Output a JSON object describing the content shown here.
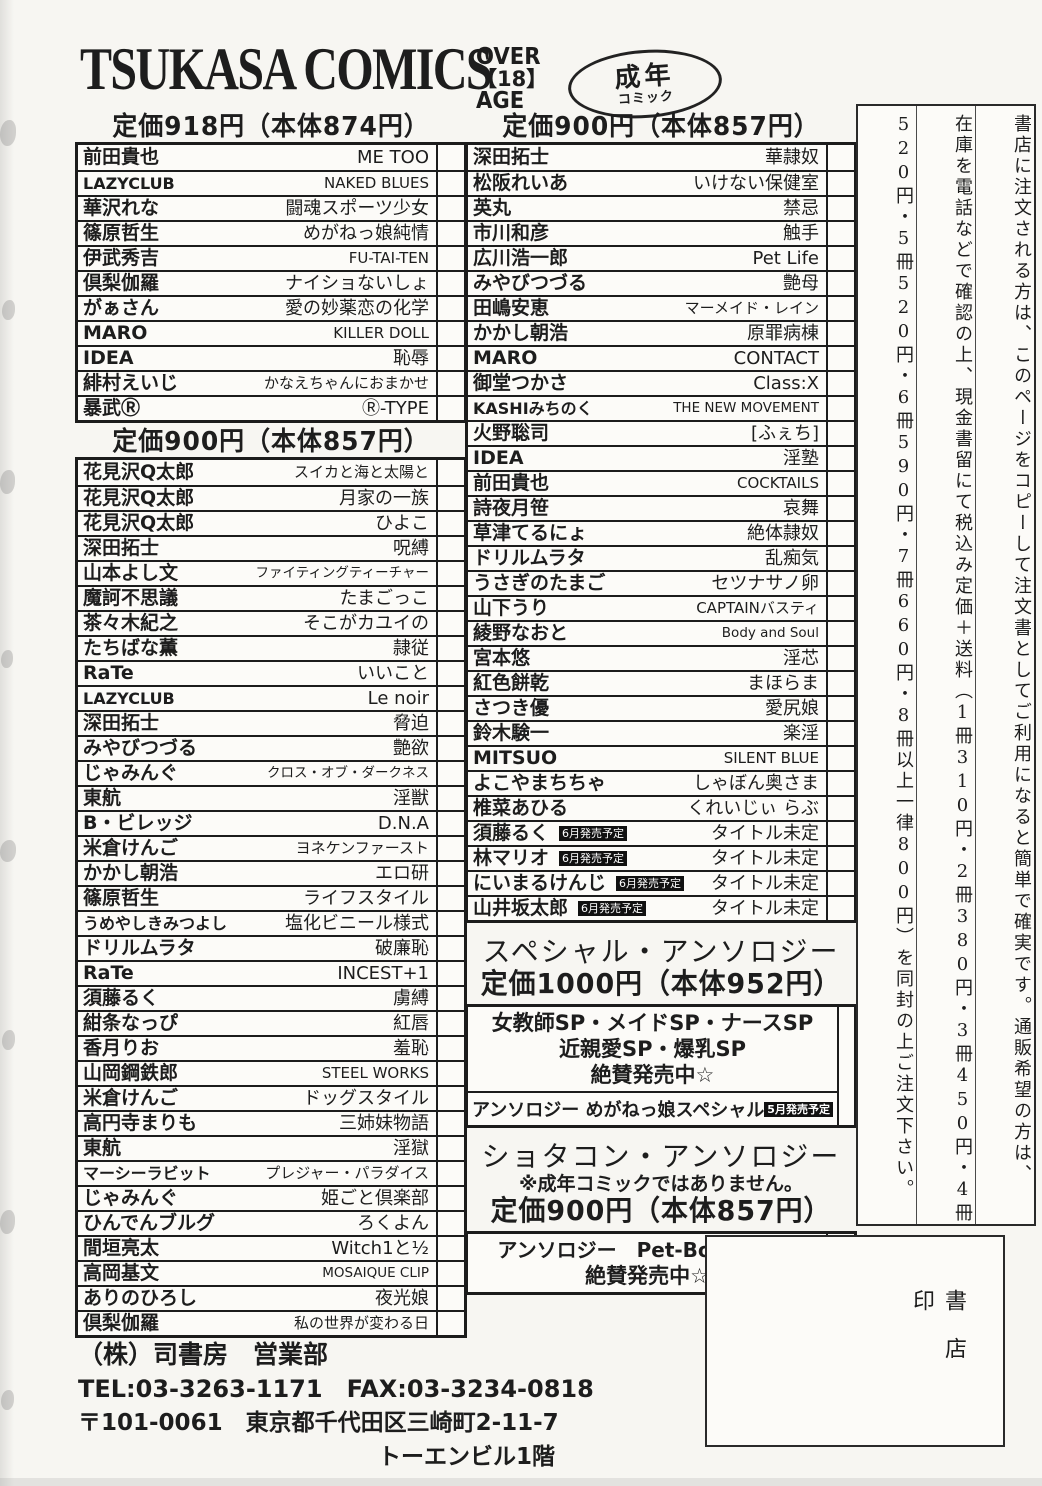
{
  "colors": {
    "ink": "#1d1d1d",
    "paper": "#f7f6f2",
    "badge_bg": "#111111",
    "badge_text": "#ffffff"
  },
  "header": {
    "logo": "TSUKASA COMICS",
    "age_badge": {
      "line1": "OVER",
      "line2": "【18】",
      "line3": "AGE"
    },
    "oval_badge": {
      "line1": "成年",
      "line2": "コミック"
    }
  },
  "sections": [
    {
      "header": "定価918円（本体874円）",
      "rows": [
        {
          "author": "前田貴也",
          "title": "ME TOO"
        },
        {
          "author": "LAZYCLUB",
          "title": "NAKED BLUES"
        },
        {
          "author": "華沢れな",
          "title": "闘魂スポーツ少女"
        },
        {
          "author": "篠原哲生",
          "title": "めがねっ娘純情"
        },
        {
          "author": "伊武秀吉",
          "title": "FU-TAI-TEN"
        },
        {
          "author": "倶梨伽羅",
          "title": "ナイショないしょ"
        },
        {
          "author": "がぁさん",
          "title": "愛の妙薬恋の化学"
        },
        {
          "author": "MARO",
          "title": "KILLER DOLL"
        },
        {
          "author": "IDEA",
          "title": "恥辱"
        },
        {
          "author": "緋村えいじ",
          "title": "かなえちゃんにおまかせ"
        },
        {
          "author": "暴武Ⓡ",
          "title": "Ⓡ-TYPE"
        }
      ]
    },
    {
      "header": "定価900円（本体857円）",
      "rows": [
        {
          "author": "花見沢Q太郎",
          "title": "スイカと海と太陽と"
        },
        {
          "author": "花見沢Q太郎",
          "title": "月家の一族"
        },
        {
          "author": "花見沢Q太郎",
          "title": "ひよこ"
        },
        {
          "author": "深田拓士",
          "title": "呪縛"
        },
        {
          "author": "山本よし文",
          "title": "ファイティングティーチャー"
        },
        {
          "author": "魔訶不思議",
          "title": "たまごっこ"
        },
        {
          "author": "茶々木紀之",
          "title": "そこがカユイの"
        },
        {
          "author": "たちばな薫",
          "title": "隷従"
        },
        {
          "author": "RaTe",
          "title": "いいこと"
        },
        {
          "author": "LAZYCLUB",
          "title": "Le noir"
        },
        {
          "author": "深田拓士",
          "title": "脅迫"
        },
        {
          "author": "みやびつづる",
          "title": "艶欲"
        },
        {
          "author": "じゃみんぐ",
          "title": "クロス・オブ・ダークネス"
        },
        {
          "author": "東航",
          "title": "淫獣"
        },
        {
          "author": "B・ビレッジ",
          "title": "D.N.A"
        },
        {
          "author": "米倉けんご",
          "title": "ヨネケンファースト"
        },
        {
          "author": "かかし朝浩",
          "title": "エロ研"
        },
        {
          "author": "篠原哲生",
          "title": "ライフスタイル"
        },
        {
          "author": "うめやしきみつよし",
          "title": "塩化ビニール様式"
        },
        {
          "author": "ドリルムラタ",
          "title": "破廉恥"
        },
        {
          "author": "RaTe",
          "title": "INCEST+1"
        },
        {
          "author": "須藤るく",
          "title": "虜縛"
        },
        {
          "author": "紺条なっぴ",
          "title": "紅唇"
        },
        {
          "author": "香月りお",
          "title": "羞恥"
        },
        {
          "author": "山岡鋼鉄郎",
          "title": "STEEL WORKS"
        },
        {
          "author": "米倉けんご",
          "title": "ドッグスタイル"
        },
        {
          "author": "高円寺まりも",
          "title": "三姉妹物語"
        },
        {
          "author": "東航",
          "title": "淫獄"
        },
        {
          "author": "マーシーラビット",
          "title": "プレジャー・パラダイス"
        },
        {
          "author": "じゃみんぐ",
          "title": "姫ごと倶楽部"
        },
        {
          "author": "ひんでんブルグ",
          "title": "ろくよん"
        },
        {
          "author": "間垣亮太",
          "title": "Witch1と½"
        },
        {
          "author": "高岡基文",
          "title": "MOSAIQUE CLIP"
        },
        {
          "author": "ありのひろし",
          "title": "夜光娘"
        },
        {
          "author": "倶梨伽羅",
          "title": "私の世界が変わる日"
        }
      ]
    },
    {
      "header": "定価900円（本体857円）",
      "rows": [
        {
          "author": "深田拓士",
          "title": "華隷奴"
        },
        {
          "author": "松阪れいあ",
          "title": "いけない保健室"
        },
        {
          "author": "英丸",
          "title": "禁忌"
        },
        {
          "author": "市川和彦",
          "title": "触手"
        },
        {
          "author": "広川浩一郎",
          "title": "Pet Life"
        },
        {
          "author": "みやびつづる",
          "title": "艶母"
        },
        {
          "author": "田嶋安恵",
          "title": "マーメイド・レイン"
        },
        {
          "author": "かかし朝浩",
          "title": "原罪病棟"
        },
        {
          "author": "MARO",
          "title": "CONTACT"
        },
        {
          "author": "御堂つかさ",
          "title": "Class:X"
        },
        {
          "author": "KASHIみちのく",
          "title": "THE NEW MOVEMENT"
        },
        {
          "author": "火野聡司",
          "title": "[ふぇち]"
        },
        {
          "author": "IDEA",
          "title": "淫塾"
        },
        {
          "author": "前田貴也",
          "title": "COCKTAILS"
        },
        {
          "author": "詩夜月笹",
          "title": "哀舞"
        },
        {
          "author": "草津てるにょ",
          "title": "絶体隷奴"
        },
        {
          "author": "ドリルムラタ",
          "title": "乱痴気"
        },
        {
          "author": "うさぎのたまご",
          "title": "セツナサノ卵"
        },
        {
          "author": "山下うり",
          "title": "CAPTAINバスティ"
        },
        {
          "author": "綾野なおと",
          "title": "Body and Soul"
        },
        {
          "author": "宮本悠",
          "title": "淫芯"
        },
        {
          "author": "紅色餅乾",
          "title": "まほらま"
        },
        {
          "author": "さつき優",
          "title": "愛尻娘"
        },
        {
          "author": "鈴木験一",
          "title": "楽淫"
        },
        {
          "author": "MITSUO",
          "title": "SILENT BLUE"
        },
        {
          "author": "よこやまちちゃ",
          "title": "しゃぼん奥さま"
        },
        {
          "author": "椎菜あひる",
          "title": "くれいじぃ らぶ"
        },
        {
          "author": "須藤るく",
          "badge": "6月発売予定",
          "title": "タイトル未定"
        },
        {
          "author": "林マリオ",
          "badge": "6月発売予定",
          "title": "タイトル未定"
        },
        {
          "author": "にいまるけんじ",
          "badge": "6月発売予定",
          "title": "タイトル未定"
        },
        {
          "author": "山井坂太郎",
          "badge": "6月発売予定",
          "title": "タイトル未定"
        }
      ]
    }
  ],
  "special_anthology": {
    "title": "スペシャル・アンソロジー",
    "price": "定価1000円（本体952円）",
    "box_lines": [
      "女教師SP・メイドSP・ナースSP",
      "近親愛SP・爆乳SP",
      "絶賛発売中☆"
    ],
    "row": {
      "label": "アンソロジー めがねっ娘スペシャル",
      "badge": "5月発売予定"
    }
  },
  "shotacon_anthology": {
    "title": "ショタコン・アンソロジー",
    "note": "※成年コミックではありません。",
    "price": "定価900円（本体857円）",
    "box_lines": [
      "アンソロジー　Pet-Boy's①～⑩",
      "絶賛発売中☆"
    ]
  },
  "order_info": {
    "columns": [
      "書店に注文される方は、このページをコピーして注文書としてご利用になると簡単で確実です。通販希望の方は、",
      "在庫を電話などで確認の上、現金書留にて税込み定価＋送料（1冊310円・2冊380円・3冊450円・4冊",
      "520円・5冊520円・6冊590円・7冊660円・8冊以上一律800円）を同封の上ご注文下さい。"
    ]
  },
  "stamp_box": {
    "label": "書店印"
  },
  "footer": {
    "company": "（株）司書房　営業部",
    "tel_fax": "TEL:03-3263-1171　FAX:03-3234-0818",
    "address": "〒101-0061　東京都千代田区三崎町2-11-7",
    "building": "トーエンビル1階"
  }
}
